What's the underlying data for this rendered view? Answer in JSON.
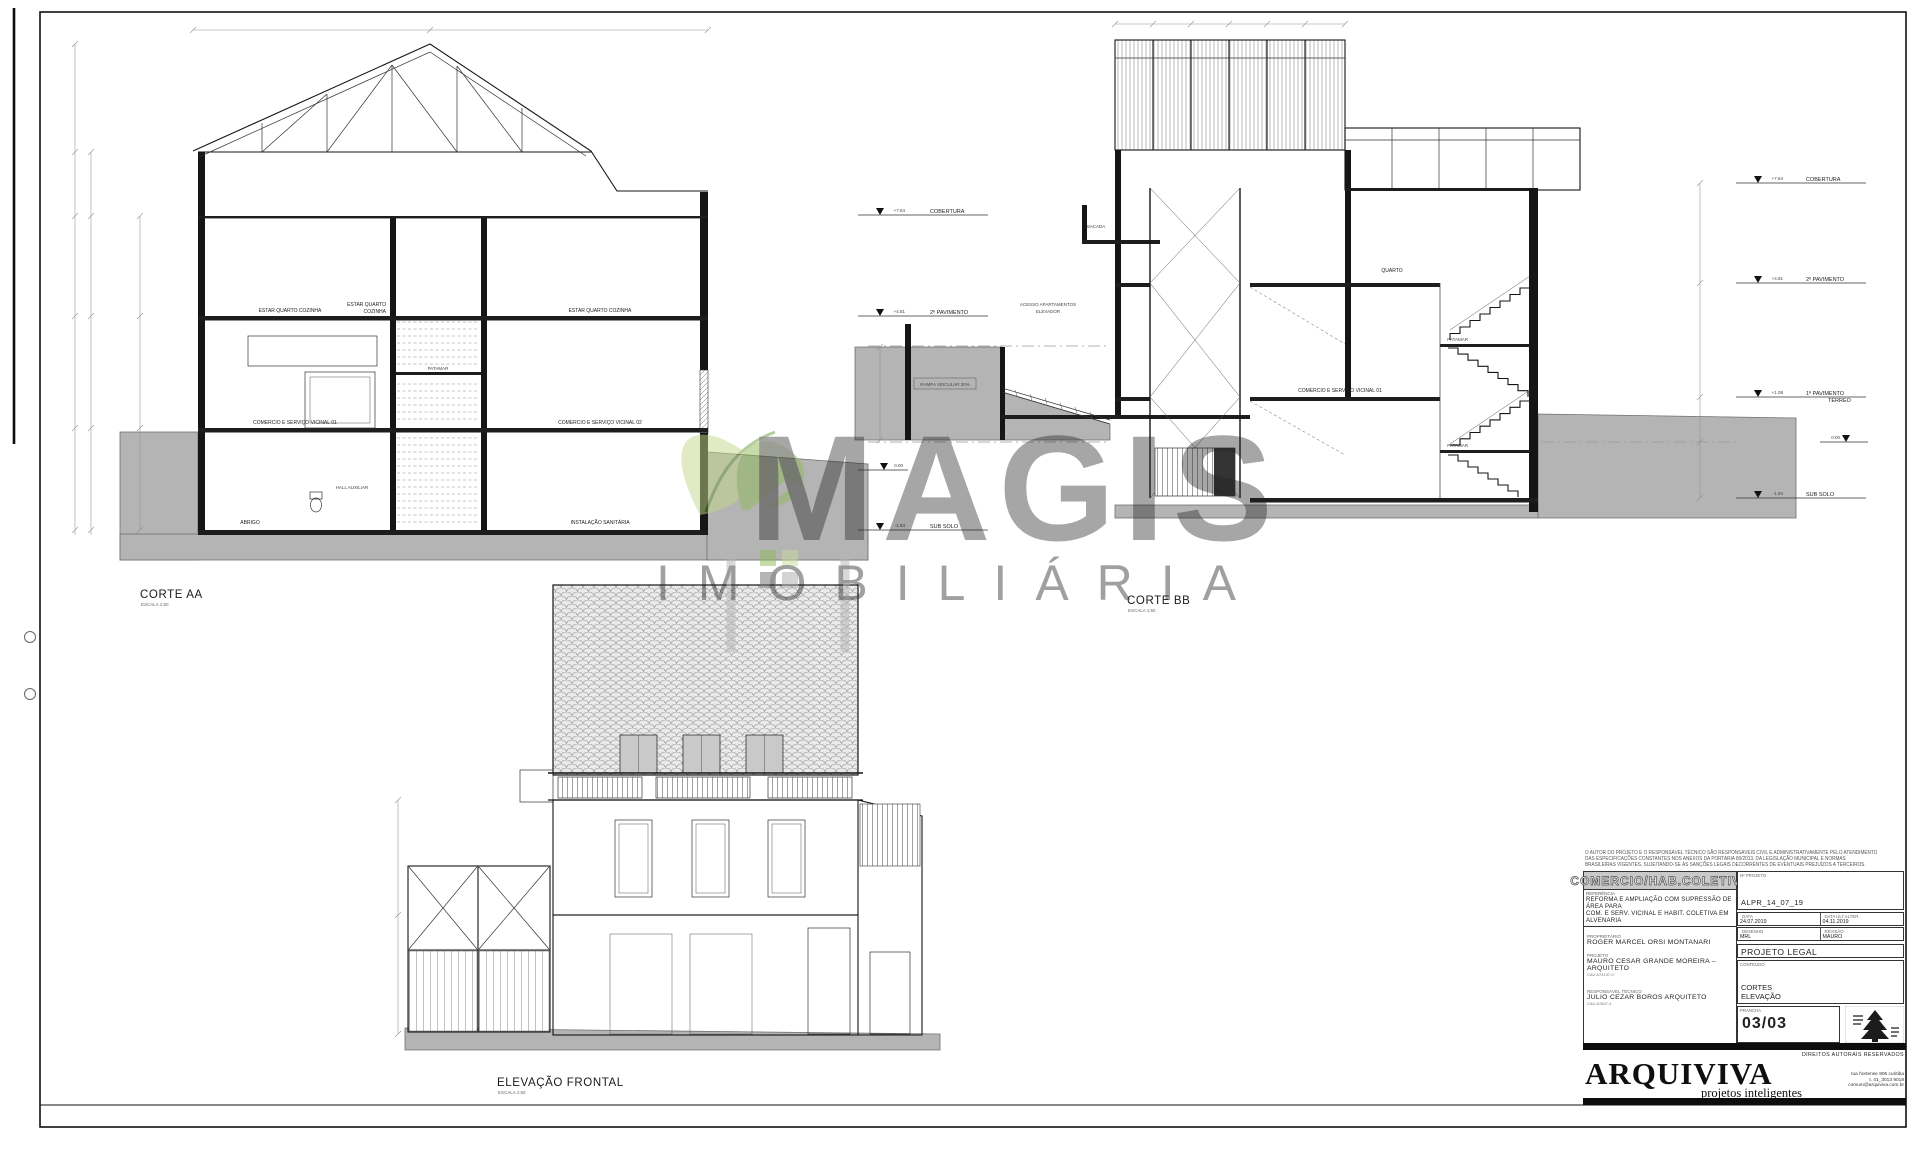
{
  "drawings": {
    "corte_aa": {
      "title": "CORTE AA",
      "scale": "ESCALA  1:50"
    },
    "corte_bb": {
      "title": "CORTE BB",
      "scale": "ESCALA  1:50"
    },
    "elevacao": {
      "title": "ELEVAÇÃO FRONTAL",
      "scale": "ESCALA  1:50"
    }
  },
  "levels": {
    "cobertura": {
      "value": "+7.64",
      "label": "COBERTURA"
    },
    "pav2": {
      "value": "+4.81",
      "label": "2º PAVIMENTO"
    },
    "pav1": {
      "value": "+1.08",
      "label": "1º PAVIMENTO",
      "label2": "TÉRREO"
    },
    "zero": {
      "value": "0.00"
    },
    "subsolo": {
      "value": "-1.94",
      "label": "SUB SOLO"
    }
  },
  "rooms": {
    "estar": "ESTAR QUARTO COZINHA",
    "estar_l1": "ESTAR QUARTO",
    "estar_l2": "COZINHA",
    "com01": "COMERCIO E SERVIÇO VICINAL 01",
    "com02": "COMERCIO E SERVIÇO VICINAL 02",
    "patamar": "PATAMAR",
    "abrigo": "ABRIGO",
    "hall": "HALL AUXILIAR",
    "sanitaria": "INSTALAÇÃO SANITÁRIA",
    "sacada": "SACADA",
    "quarto": "QUARTO",
    "acesso1": "ACESSO APARTAMENTOS",
    "acesso2": "ELEVADOR",
    "rampa": "RAMPA VEICULAR 30%"
  },
  "watermark": {
    "brand": "MAGIS",
    "subtitle": "IMOBILIÁRIA"
  },
  "titleblock": {
    "disclaimer1": "O AUTOR DO PROJETO E O RESPONSÁVEL TÉCNICO SÃO RESPONSÁVEIS CIVIL E ADMINISTRATIVAMENTE PELO ATENDIMENTO",
    "disclaimer2": "DAS ESPECIFICAÇÕES CONSTANTES NOS ANEXOS DA PORTARIA 80/2013, DA LEGISLAÇÃO MUNICIPAL E NORMAS",
    "disclaimer3": "BRASILEIRAS VIGENTES, SUJEITANDO-SE ÀS SANÇÕES LEGAIS DECORRENTES DE EVENTUAIS PREJUÍZOS A TERCEIROS.",
    "category": "COMERCIO/HAB.COLETIVA",
    "project_no_label": "Nº  PROJETO",
    "project_no": "ALPR_14_07_19",
    "referencia_label": "REFERÊNCIA",
    "referencia1": "REFORMA E AMPLIAÇÃO COM SUPRESSÃO DE ÁREA PARA",
    "referencia2": "COM. E SERV. VICINAL E HABIT. COLETIVA EM ALVENARIA",
    "proprietario_label": "PROPRIETÁRIO",
    "proprietario": "ROGER MARCEL ORSI MONTANARI",
    "projeto_label": "PROJETO",
    "projeto": "MAURO CESAR GRANDE MOREIRA – ARQUITETO",
    "projeto_cau": "CAU A74137-0",
    "resp_label": "RESPONSÁVEL TÉCNICO",
    "resp": "JULIO CEZAR BOROS ARQUITETO",
    "resp_cau": "CAU A7847-4",
    "data_label": "DATA",
    "data_value": "24.07.2019",
    "data_alt_label": "DATA ÚLT.ALTER.",
    "data_alt_value": "04.11.2019",
    "desenho_label": "DESENHO",
    "desenho_value": "MRL",
    "revisao_label": "REVISÃO",
    "revisao_value": "MAURO",
    "fase": "PROJETO LEGAL",
    "conteudo_label": "CONTEÚDO",
    "conteudo1": "CORTES",
    "conteudo2": "ELEVAÇÃO",
    "prancha_label": "PRANCHA",
    "prancha": "03/03",
    "rights": "DIREITOS AUTORAIS RESERVADOS",
    "brand": "ARQUIVIVA",
    "brand_sub": "projetos inteligentes",
    "contact1": "rua hortense 806 curitiba",
    "contact2": "t. 41_3013 9018",
    "contact3": "comum@arquiviva.com.br"
  }
}
